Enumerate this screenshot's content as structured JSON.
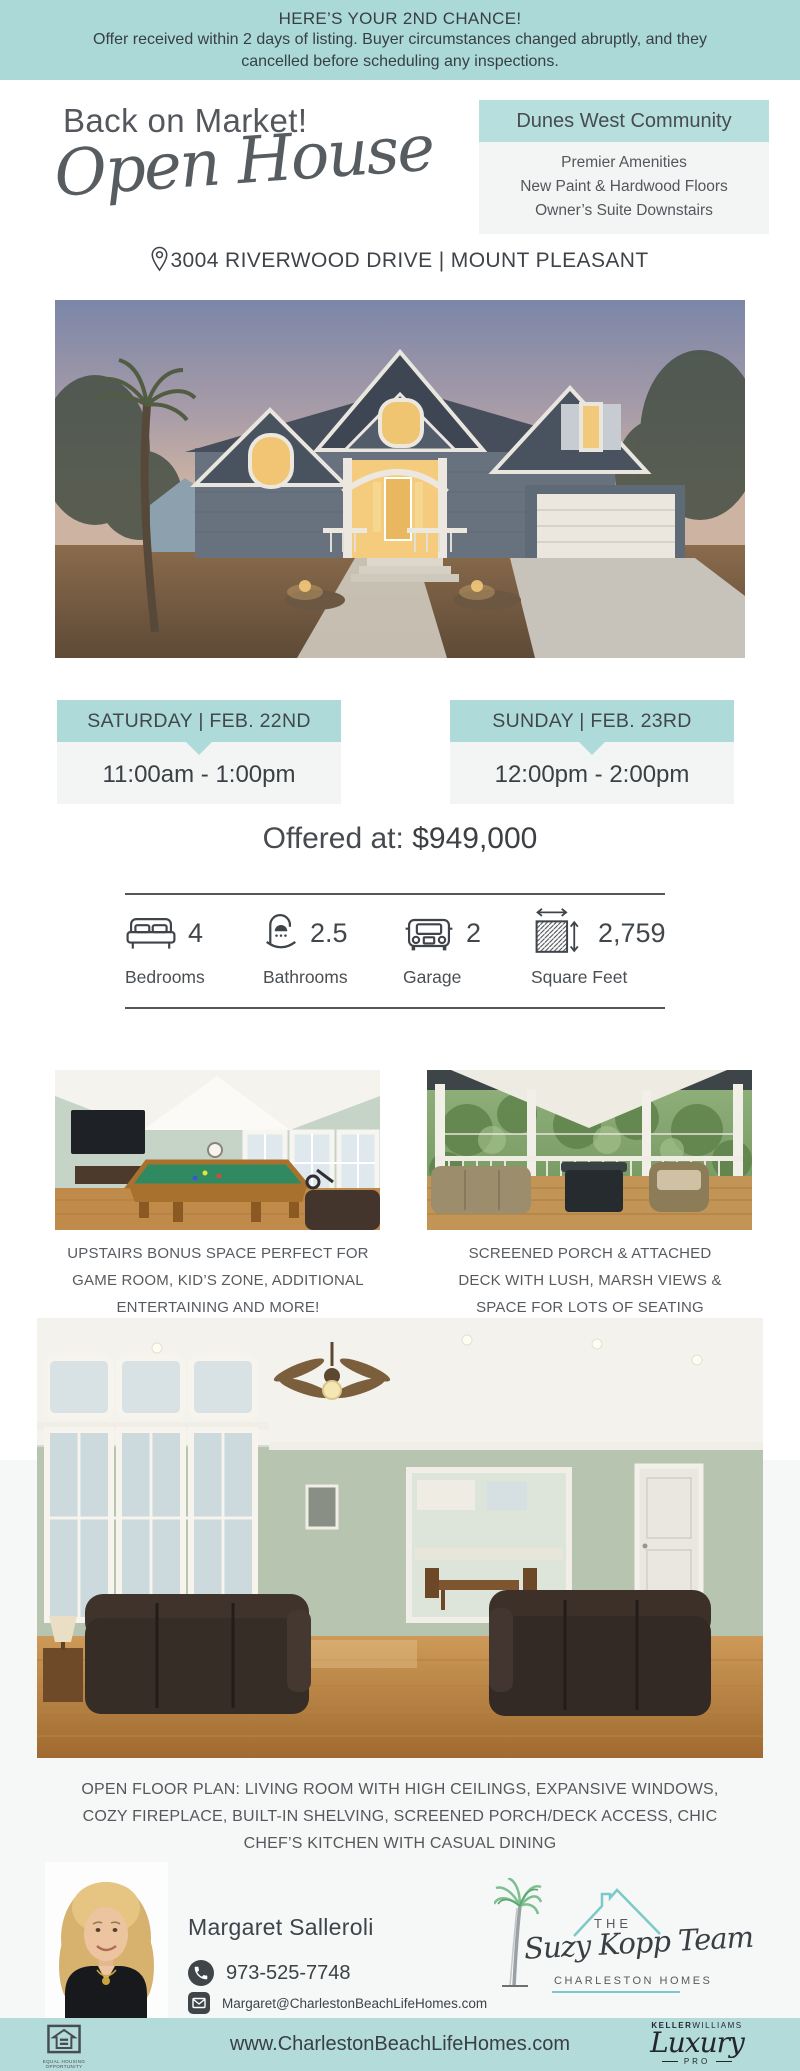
{
  "colors": {
    "teal": "#aedbda",
    "teal_light": "#b7dfde",
    "box_gray": "#f3f4f4",
    "text_dark": "#3f444a",
    "logo_teal": "#7ccac8"
  },
  "banner": {
    "title": "HERE’S YOUR 2ND CHANCE!",
    "lines": [
      "Offer received within 2 days of listing. Buyer circumstances changed abruptly, and they",
      "cancelled before scheduling any inspections."
    ]
  },
  "header": {
    "kicker": "Back on Market!",
    "script_title": "Open House",
    "address": "3004 RIVERWOOD DRIVE | MOUNT PLEASANT"
  },
  "community_box": {
    "title": "Dunes West Community",
    "features": [
      "Premier Amenities",
      "New Paint & Hardwood Floors",
      "Owner’s Suite Downstairs"
    ]
  },
  "open_house_sessions": [
    {
      "day": "SATURDAY | FEB. 22ND",
      "time": "11:00am - 1:00pm"
    },
    {
      "day": "SUNDAY | FEB. 23RD",
      "time": "12:00pm - 2:00pm"
    }
  ],
  "price": {
    "prefix": "Offered at:",
    "amount": "$949,000"
  },
  "stats": [
    {
      "value": "4",
      "label": "Bedrooms"
    },
    {
      "value": "2.5",
      "label": "Bathrooms"
    },
    {
      "value": "2",
      "label": "Garage"
    },
    {
      "value": "2,759",
      "label": "Square Feet"
    }
  ],
  "captions": {
    "bonus_room": [
      "UPSTAIRS BONUS SPACE PERFECT FOR",
      "GAME ROOM, KID’S ZONE, ADDITIONAL",
      "ENTERTAINING AND MORE!"
    ],
    "porch": [
      "SCREENED PORCH & ATTACHED",
      "DECK WITH LUSH, MARSH VIEWS &",
      "SPACE FOR LOTS OF SEATING"
    ]
  },
  "description_lines": [
    "OPEN FLOOR PLAN: LIVING ROOM WITH HIGH CEILINGS, EXPANSIVE WINDOWS,",
    "COZY FIREPLACE, BUILT-IN SHELVING, SCREENED PORCH/DECK ACCESS, CHIC",
    "CHEF’S KITCHEN WITH CASUAL DINING"
  ],
  "agent": {
    "name": "Margaret Salleroli",
    "phone": "973-525-7748",
    "email": "Margaret@CharlestonBeachLifeHomes.com"
  },
  "team_logo": {
    "the": "THE",
    "name": "Suzy Kopp Team",
    "subtitle": "CHARLESTON HOMES"
  },
  "footer": {
    "website": "www.CharlestonBeachLifeHomes.com",
    "kw_bold": "KELLER",
    "kw_light": "WILLIAMS",
    "kw_script": "Luxury",
    "kw_sub": "PRO",
    "eh_line1": "EQUAL HOUSING",
    "eh_line2": "OPPORTUNITY"
  }
}
